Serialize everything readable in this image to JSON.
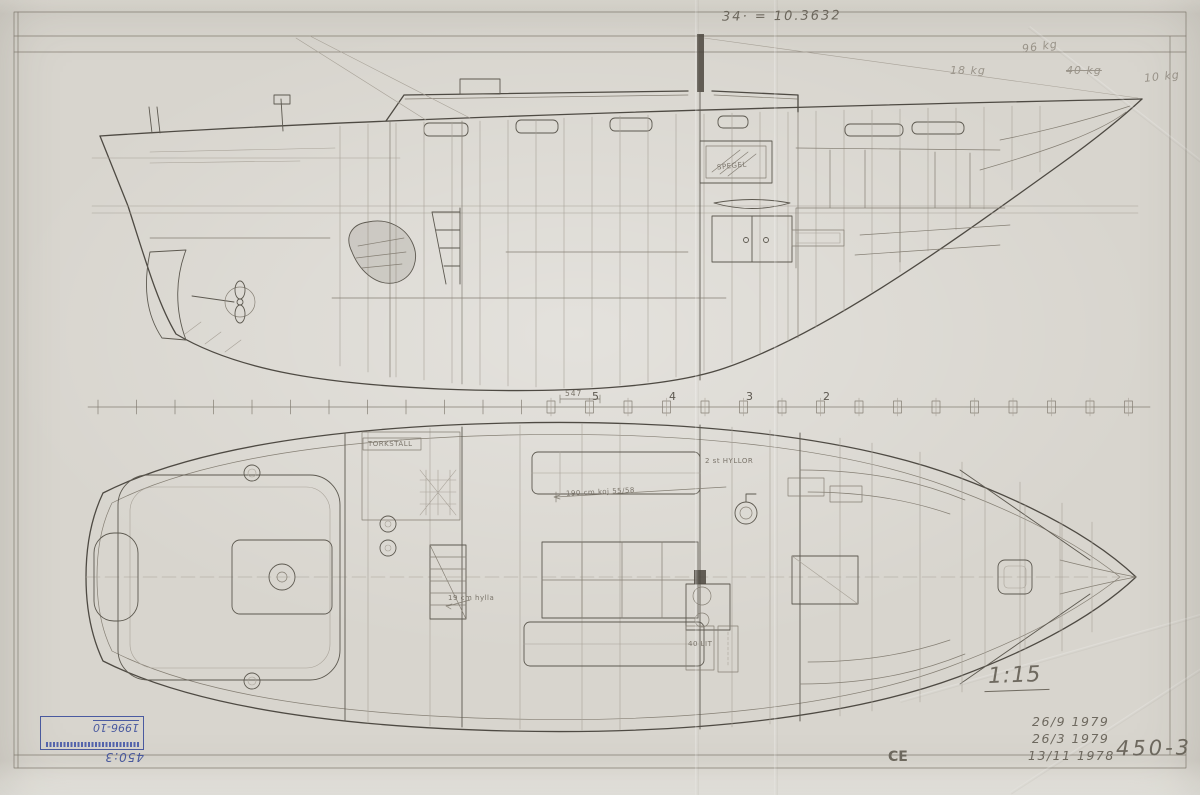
{
  "annotations": {
    "formula": "34· = 10.3632",
    "weights": [
      "96 kg",
      "18 kg",
      "40 kg",
      "10 kg"
    ],
    "scale": "1:15",
    "dates": [
      "26/9 1979",
      "26/3 1979",
      "13/11 1978"
    ],
    "monogram": "CE",
    "drawing_number": "450-3"
  },
  "stamp": {
    "handwritten_year": "1996-10",
    "handwritten_number": "450:3"
  },
  "labels": {
    "mirror": "SPEGEL",
    "drying_rack": "TORKSTÄLL",
    "shelves": "2 st HYLLOR",
    "berth_length": "190 cm koj 55/58",
    "shelf_dim": "19 cm hylla",
    "tank": "40 LIT"
  },
  "stations": {
    "numbers": [
      "5",
      "4",
      "3",
      "2"
    ],
    "dimension": "547"
  },
  "colors": {
    "pencil": "#6e695f",
    "pencil_light": "#9a948a",
    "ink_blue": "#4a5aa0",
    "paper": "#d8d5ce"
  }
}
